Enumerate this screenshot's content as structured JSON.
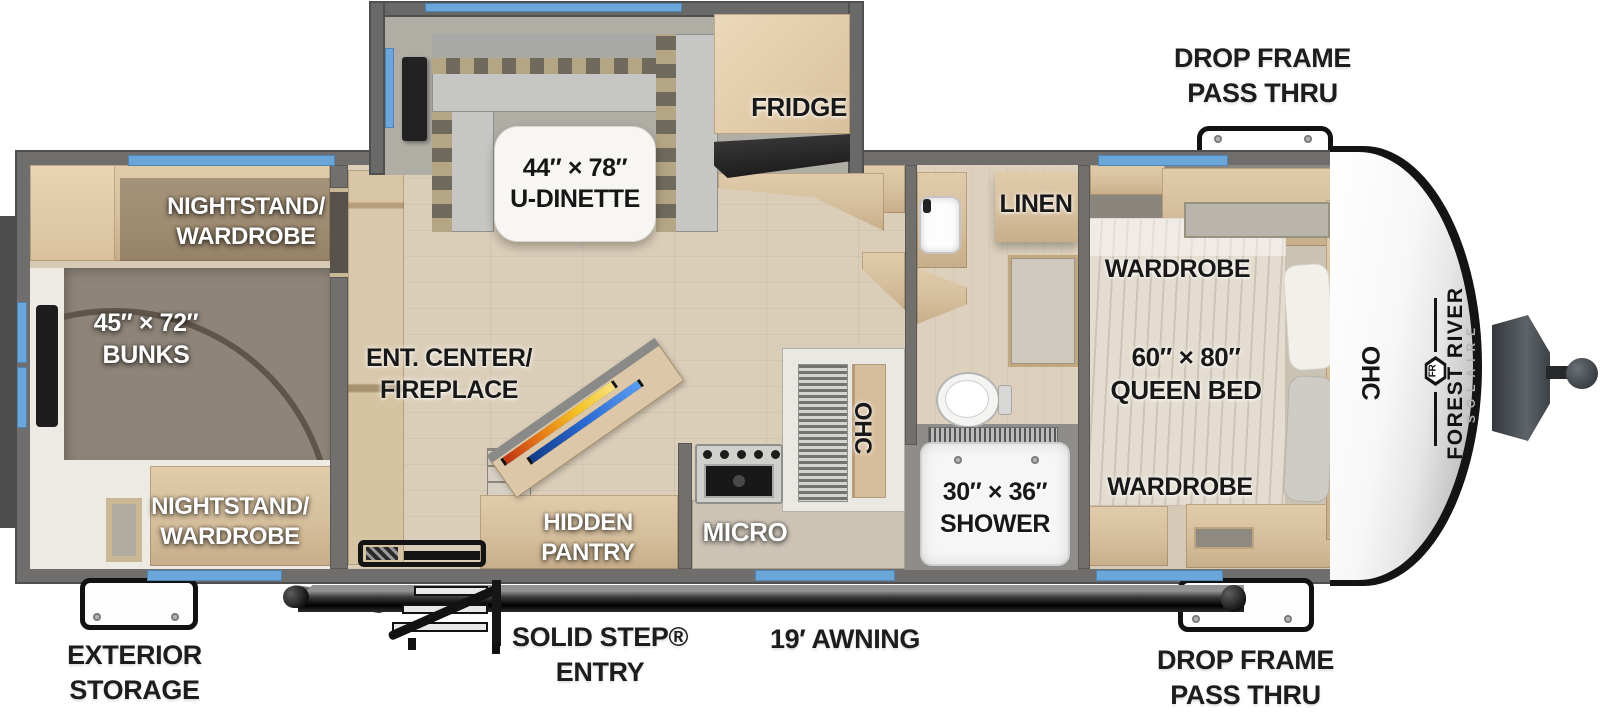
{
  "plan": {
    "brand": {
      "make": "FOREST RIVER",
      "model": "SOLAIRE",
      "logo_monogram": "FR"
    },
    "exterior": {
      "drop_frame_top": "DROP FRAME\nPASS THRU",
      "drop_frame_bottom": "DROP FRAME\nPASS THRU",
      "exterior_storage": "EXTERIOR\nSTORAGE",
      "solid_step_entry": "SOLID STEP®\nENTRY",
      "awning": "19′ AWNING",
      "ohc_front_cap": "OHC"
    },
    "bunk_room": {
      "nightstand_top": "NIGHTSTAND/\nWARDROBE",
      "bunks": "45″ × 72″\nBUNKS",
      "nightstand_bottom": "NIGHTSTAND/\nWARDROBE"
    },
    "living": {
      "u_dinette": "44″ × 78″\nU-DINETTE",
      "fridge": "FRIDGE",
      "ent_center": "ENT. CENTER/\nFIREPLACE",
      "hidden_pantry": "HIDDEN\nPANTRY",
      "micro": "MICRO",
      "ohc_kitchen": "OHC"
    },
    "bathroom": {
      "linen": "LINEN",
      "shower": "30″ × 36″\nSHOWER"
    },
    "bedroom": {
      "wardrobe_top": "WARDROBE",
      "queen_bed": "60″ × 80″\nQUEEN BED",
      "wardrobe_bottom": "WARDROBE"
    },
    "colors": {
      "window_accent": "#6aa6d9",
      "wall": "#72706d",
      "floor_wood": "#dbceb9",
      "cabinet_wood": "#d8c3a2",
      "label_dark": "#1d1d1d",
      "label_light": "#ffffff"
    }
  }
}
